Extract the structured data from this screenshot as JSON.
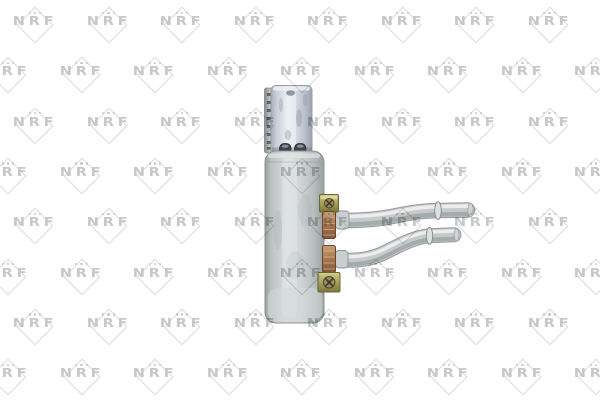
{
  "canvas": {
    "background": "#ffffff"
  },
  "watermark": {
    "text": "NRF",
    "text_color": "#c6c9c8",
    "diamond_color": "#d8dad9"
  },
  "product": {
    "colors": {
      "top_tank": "#ccd3dc",
      "core_body": "#c6cacb",
      "pipes": "#c6cbca",
      "brass_fitting": "#aba45c",
      "copper_clamp": "#a87a52",
      "ports": "#3f444a"
    }
  }
}
